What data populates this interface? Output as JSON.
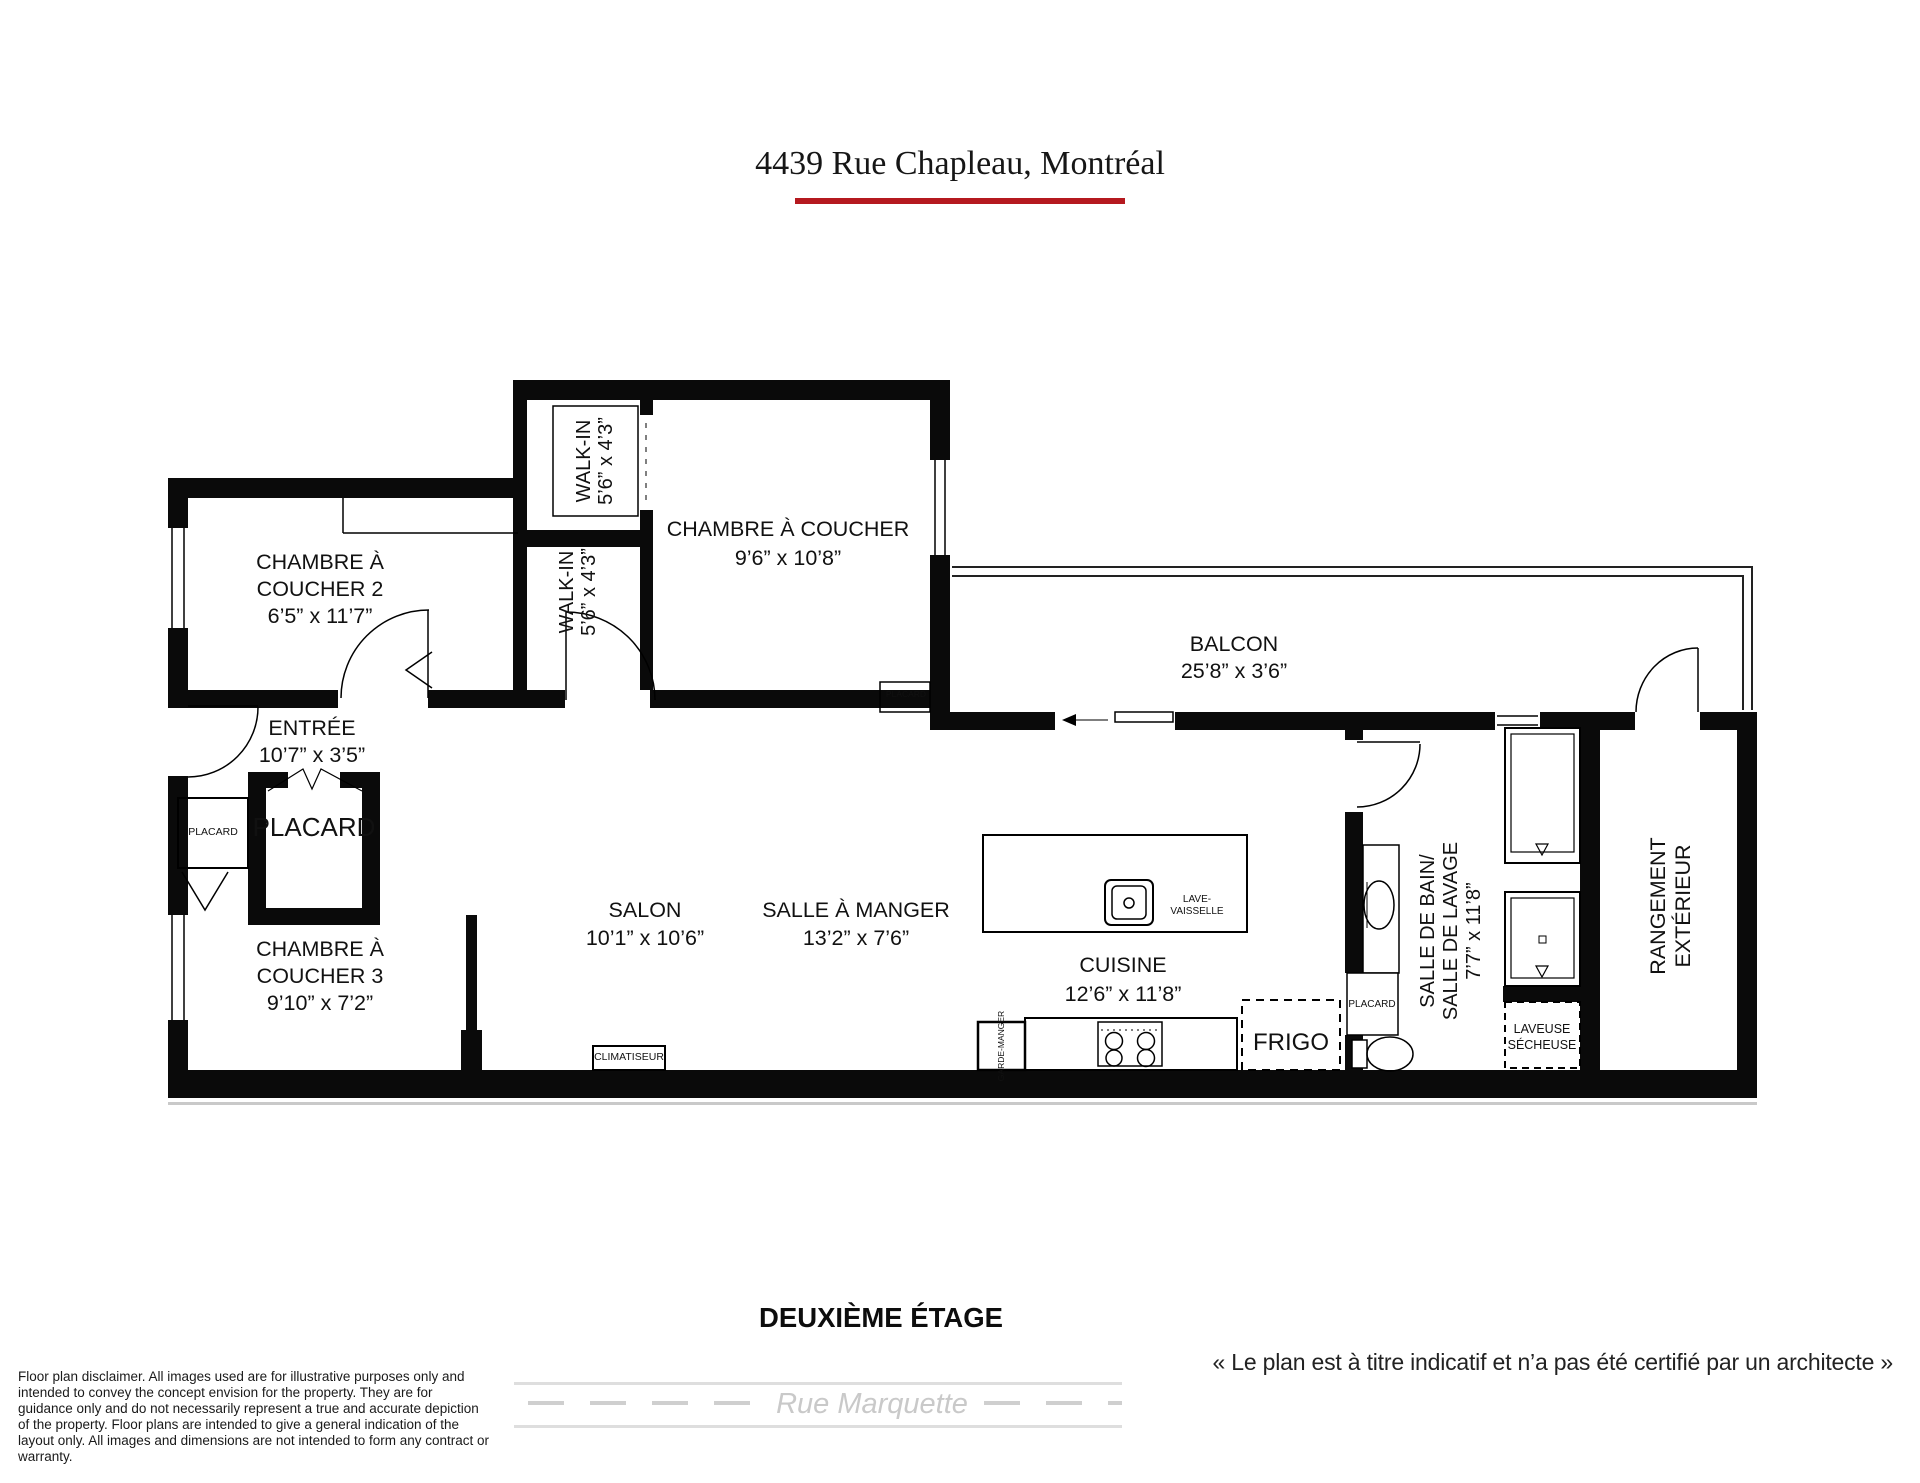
{
  "title": {
    "text": "4439 Rue Chapleau, Montréal"
  },
  "colors": {
    "accent_red": "#b5191f",
    "wall_black": "#000000",
    "street_gray": "#cfcfcf"
  },
  "rooms": {
    "chambre2": {
      "l1": "CHAMBRE À",
      "l2": "COUCHER 2",
      "dims": "6’5” x 11’7”"
    },
    "walkin_haut": {
      "l1": "WALK-IN",
      "dims": "5’6” x 4’3”"
    },
    "walkin_bas": {
      "l1": "WALK-IN",
      "dims": "5’6” x 4’3”"
    },
    "chambre_principale": {
      "l1": "CHAMBRE À COUCHER",
      "dims": "9’6” x 10’8”"
    },
    "balcon": {
      "l1": "BALCON",
      "dims": "25’8” x 3’6”"
    },
    "entree": {
      "l1": "ENTRÉE",
      "dims": "10’7” x 3’5”"
    },
    "chambre3": {
      "l1": "CHAMBRE À",
      "l2": "COUCHER 3",
      "dims": "9’10” x 7’2”"
    },
    "salon": {
      "l1": "SALON",
      "dims": "10’1” x 10’6”"
    },
    "salle_a_manger": {
      "l1": "SALLE À MANGER",
      "dims": "13’2” x 7’6”"
    },
    "cuisine": {
      "l1": "CUISINE",
      "dims": "12’6” x 11’8”"
    },
    "salle_de_bain": {
      "l1": "SALLE DE BAIN/",
      "l2": "SALLE DE LAVAGE",
      "dims": "7’7” x 11’8”"
    },
    "rangement": {
      "l1": "RANGEMENT",
      "l2": "EXTÉRIEUR"
    }
  },
  "fixtures": {
    "placard_entree_petit": "PLACARD",
    "placard_entree_grand": "PLACARD",
    "placard_chambre": "PLACARD",
    "placard_salle_de_bain": "PLACARD",
    "lave_vaisselle_l1": "LAVE-",
    "lave_vaisselle_l2": "VAISSELLE",
    "frigo": "FRIGO",
    "garde_manger": "GARDE-MANGER",
    "climatiseur": "CLIMATISEUR",
    "laveuse_l1": "LAVEUSE",
    "laveuse_l2": "SÉCHEUSE"
  },
  "footer": {
    "floor_label": "DEUXIÈME ÉTAGE",
    "caption": "« Le plan est à titre indicatif et n’a pas été certifié par un architecte »",
    "street": "Rue Marquette",
    "disclaimer": "Floor plan disclaimer. All images used are for illustrative purposes only and intended to convey the concept envision for the property. They are for guidance only and do not necessarily represent a true and accurate depiction of the property. Floor plans are intended to give a general indication of the layout only. All images and dimensions are not intended to form any contract or warranty."
  }
}
